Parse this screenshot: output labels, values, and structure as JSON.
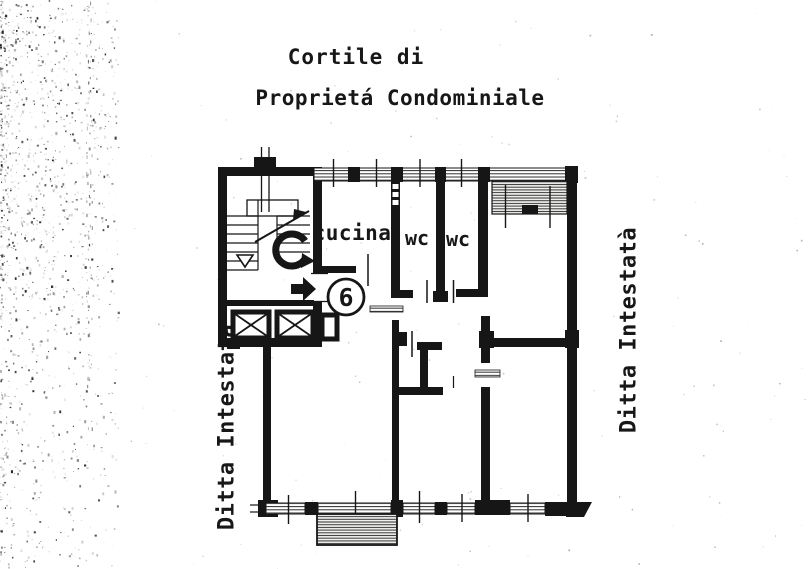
{
  "document": {
    "title_line1": "Cortile di",
    "title_line2": "Proprietá Condominiale"
  },
  "plan": {
    "kitchen_label": "cucina",
    "wc1_label": "wc",
    "wc2_label": "wc",
    "unit_number": "6",
    "left_side_label": "Ditta Intestata",
    "right_side_label": "Ditta Intestatà",
    "stair_mark": "C"
  },
  "icons": {
    "entry_arrow": "right-arrow",
    "stair_down_marker": "triangle-down",
    "elevator": "crossed-box",
    "stair_up_arrow": "diagonal-arrow"
  },
  "colors": {
    "ink": "#1a1a1a",
    "paper": "#ffffff"
  }
}
